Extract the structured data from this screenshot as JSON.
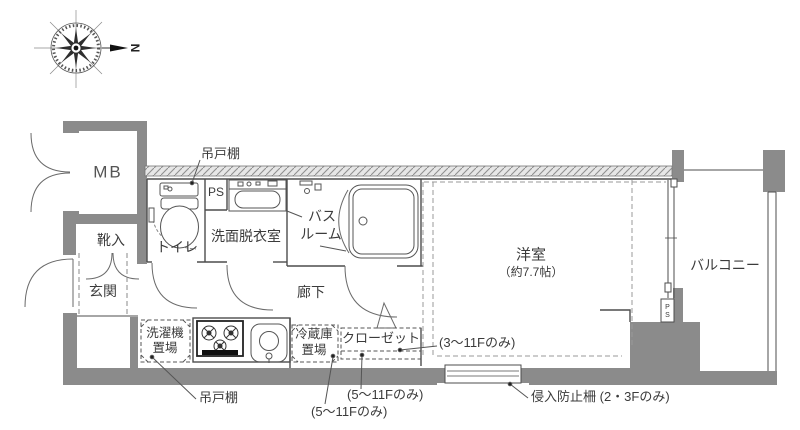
{
  "compass": {
    "north": "N"
  },
  "rooms": {
    "mb": "MB",
    "shoe_box": "靴入",
    "entrance": "玄関",
    "toilet": "トイレ",
    "pipe_space": "PS",
    "washroom": "洗面脱衣室",
    "bathroom_line1": "バス",
    "bathroom_line2": "ルーム",
    "hallway": "廊下",
    "western_room": "洋室",
    "western_room_size": "（約7.7帖）",
    "balcony": "バルコニー",
    "pipe_space_side_p": "P",
    "pipe_space_side_s": "S"
  },
  "equipment": {
    "washer_line1": "洗濯機",
    "washer_line2": "置場",
    "fridge_line1": "冷蔵庫",
    "fridge_line2": "置場",
    "closet": "クローゼット"
  },
  "annotations": {
    "hanging_cupboard_top": "吊戸棚",
    "hanging_cupboard_bottom": "吊戸棚",
    "floors_3_11": "(3〜11Fのみ)",
    "floors_5_11_closet": "(5〜11Fのみ)",
    "floors_5_11_fridge": "(5〜11Fのみ)",
    "intrusion_fence": "侵入防止柵 (2・3Fのみ)"
  },
  "colors": {
    "wall": "#8b8b8b",
    "line": "#4d4d4d",
    "background": "#ffffff"
  }
}
